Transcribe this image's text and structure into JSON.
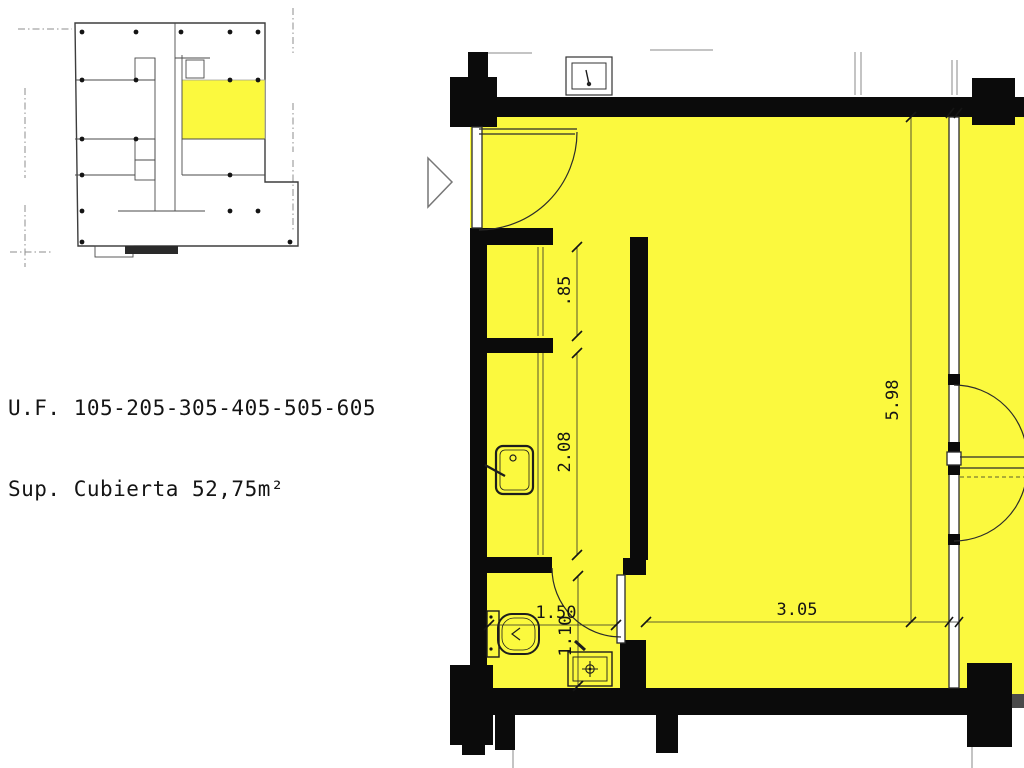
{
  "unit_info": {
    "line1": "U.F. 105-205-305-405-505-605",
    "line2": "Sup. Cubierta 52,75m²"
  },
  "dimensions": {
    "hall_opening": ".85",
    "kitchen_depth": "2.08",
    "bath_width": "1.50",
    "bath_depth": "1.10",
    "room_width": "3.05",
    "room_depth": "5.98"
  },
  "colors": {
    "highlight": "#FBF93E",
    "wall": "#0b0b0b",
    "line": "#2b2b2b"
  }
}
